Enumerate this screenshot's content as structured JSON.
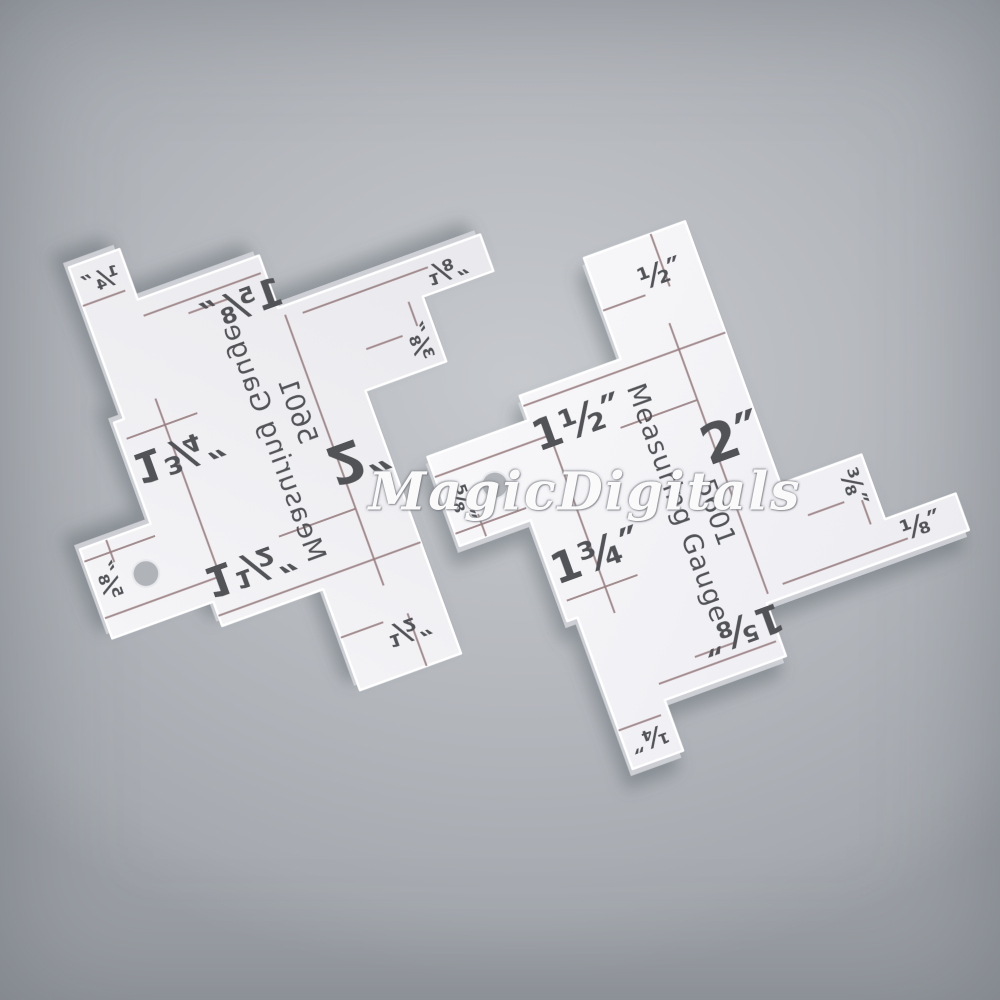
{
  "scene": {
    "background_color": "#b6b9be",
    "vignette_color": "#9b9fa5",
    "watermark": {
      "text": "MagicDigitals",
      "color": "#ffffff"
    }
  },
  "gauge": {
    "title": "Measuring Gauge",
    "model": "5601",
    "unit": "inch",
    "plate_color_front": "#f5f5f7",
    "plate_color_back": "#f1f1f4",
    "plate_edge_color": "#d2d4d9",
    "edge_highlight_color": "#ffffff",
    "engraved_line_color": "#997e80",
    "label_color": "#515257",
    "hole": {
      "x": 0.2,
      "y": 0.85,
      "r": 0.062
    },
    "outline": [
      [
        0.45,
        0.5
      ],
      [
        0.95,
        0.5
      ],
      [
        0.95,
        0.0
      ],
      [
        1.45,
        0.0
      ],
      [
        1.45,
        1.3
      ],
      [
        1.85,
        1.3
      ],
      [
        1.85,
        1.62
      ],
      [
        2.2,
        1.62
      ],
      [
        2.2,
        1.8
      ],
      [
        1.2,
        1.8
      ],
      [
        1.2,
        2.06
      ],
      [
        0.6,
        2.06
      ],
      [
        0.6,
        2.31
      ],
      [
        0.35,
        2.31
      ],
      [
        0.35,
        1.56
      ],
      [
        0.3,
        1.56
      ],
      [
        0.3,
        1.06
      ],
      [
        -0.05,
        1.06
      ],
      [
        -0.05,
        0.62
      ],
      [
        0.45,
        0.62
      ]
    ],
    "lines": [
      [
        0.95,
        0.26,
        1.16,
        0.26
      ],
      [
        0.45,
        0.55,
        1.45,
        0.55
      ],
      [
        0.84,
        0.8,
        1.22,
        0.8
      ],
      [
        1.22,
        0.42,
        1.22,
        1.76
      ],
      [
        1.28,
        0.0,
        1.28,
        0.26
      ],
      [
        0.52,
        0.64,
        0.52,
        1.6
      ],
      [
        -0.05,
        0.72,
        0.52,
        0.72
      ],
      [
        -0.05,
        1.0,
        0.3,
        1.0
      ],
      [
        0.08,
        0.95,
        0.08,
        1.06
      ],
      [
        0.33,
        1.47,
        0.68,
        1.47
      ],
      [
        0.8,
        1.92,
        1.0,
        1.92
      ],
      [
        0.35,
        2.12,
        0.56,
        2.12
      ],
      [
        1.78,
        1.5,
        1.78,
        1.62
      ],
      [
        1.52,
        1.48,
        1.7,
        1.48
      ],
      [
        1.3,
        1.74,
        1.92,
        1.74
      ],
      [
        0.6,
        1.98,
        1.18,
        1.98
      ]
    ],
    "labels": [
      {
        "id": "half-inch",
        "text": "½″",
        "x": 1.26,
        "y": 0.19,
        "rot": 0,
        "size": 0.14
      },
      {
        "id": "one-and-half-inch",
        "text": "1½″",
        "x": 0.66,
        "y": 0.71,
        "rot": 0,
        "size": 0.2
      },
      {
        "id": "two-inch",
        "text": "2″",
        "x": 1.31,
        "y": 1.02,
        "rot": 0,
        "size": 0.25
      },
      {
        "id": "five-eighths-inch",
        "text": "⅝″",
        "x": 0.02,
        "y": 0.88,
        "rot": 90,
        "size": 0.12
      },
      {
        "id": "one-three-quarters-inch",
        "text": "1¾″",
        "x": 0.53,
        "y": 1.32,
        "rot": 0,
        "size": 0.2
      },
      {
        "id": "one-five-eighths-inch",
        "text": "1⅝″",
        "x": 1.05,
        "y": 1.87,
        "rot": 180,
        "size": 0.18
      },
      {
        "id": "quarter-inch",
        "text": "¼″",
        "x": 0.47,
        "y": 2.2,
        "rot": 180,
        "size": 0.12
      },
      {
        "id": "three-eighths-inch",
        "text": "⅜″",
        "x": 1.76,
        "y": 1.43,
        "rot": 90,
        "size": 0.12
      },
      {
        "id": "one-eighth-inch",
        "text": "⅛″",
        "x": 2.0,
        "y": 1.7,
        "rot": 0,
        "size": 0.13
      },
      {
        "id": "title",
        "text": "Measuring Gauge",
        "x": 0.97,
        "y": 1.22,
        "rot": 90,
        "size": 0.125
      },
      {
        "id": "model",
        "text": "5601",
        "x": 1.12,
        "y": 1.32,
        "rot": 90,
        "size": 0.125
      }
    ]
  },
  "instances": [
    {
      "name": "measuring-gauge-back-mirrored",
      "side": "back-mirrored",
      "tx": 168,
      "ty": 760,
      "rotate": -20,
      "flip": true
    },
    {
      "name": "measuring-gauge-front",
      "side": "front",
      "tx": 392,
      "ty": 328,
      "rotate": -20,
      "flip": false
    }
  ]
}
